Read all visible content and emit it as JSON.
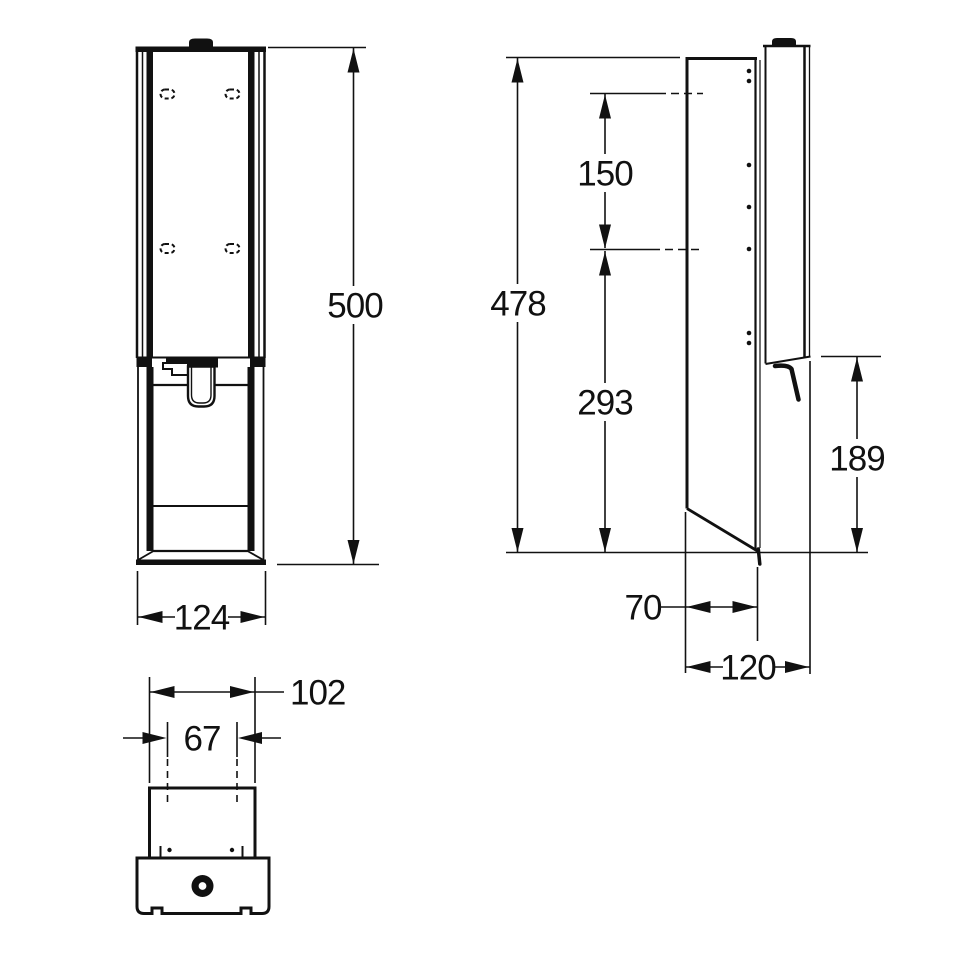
{
  "drawing": {
    "kind": "technical-drawing",
    "views": [
      "front-view",
      "side-view",
      "bottom-view"
    ],
    "line_color": "#111111",
    "background": "#ffffff"
  },
  "dimensions": {
    "front_height": "500",
    "front_width": "124",
    "side_height": "478",
    "side_hole_spacing": "150",
    "side_lower_span": "293",
    "side_flap_height": "189",
    "side_flap_depth": "70",
    "side_total_depth": "120",
    "bottom_body_width": "102",
    "bottom_recess_width": "67"
  }
}
